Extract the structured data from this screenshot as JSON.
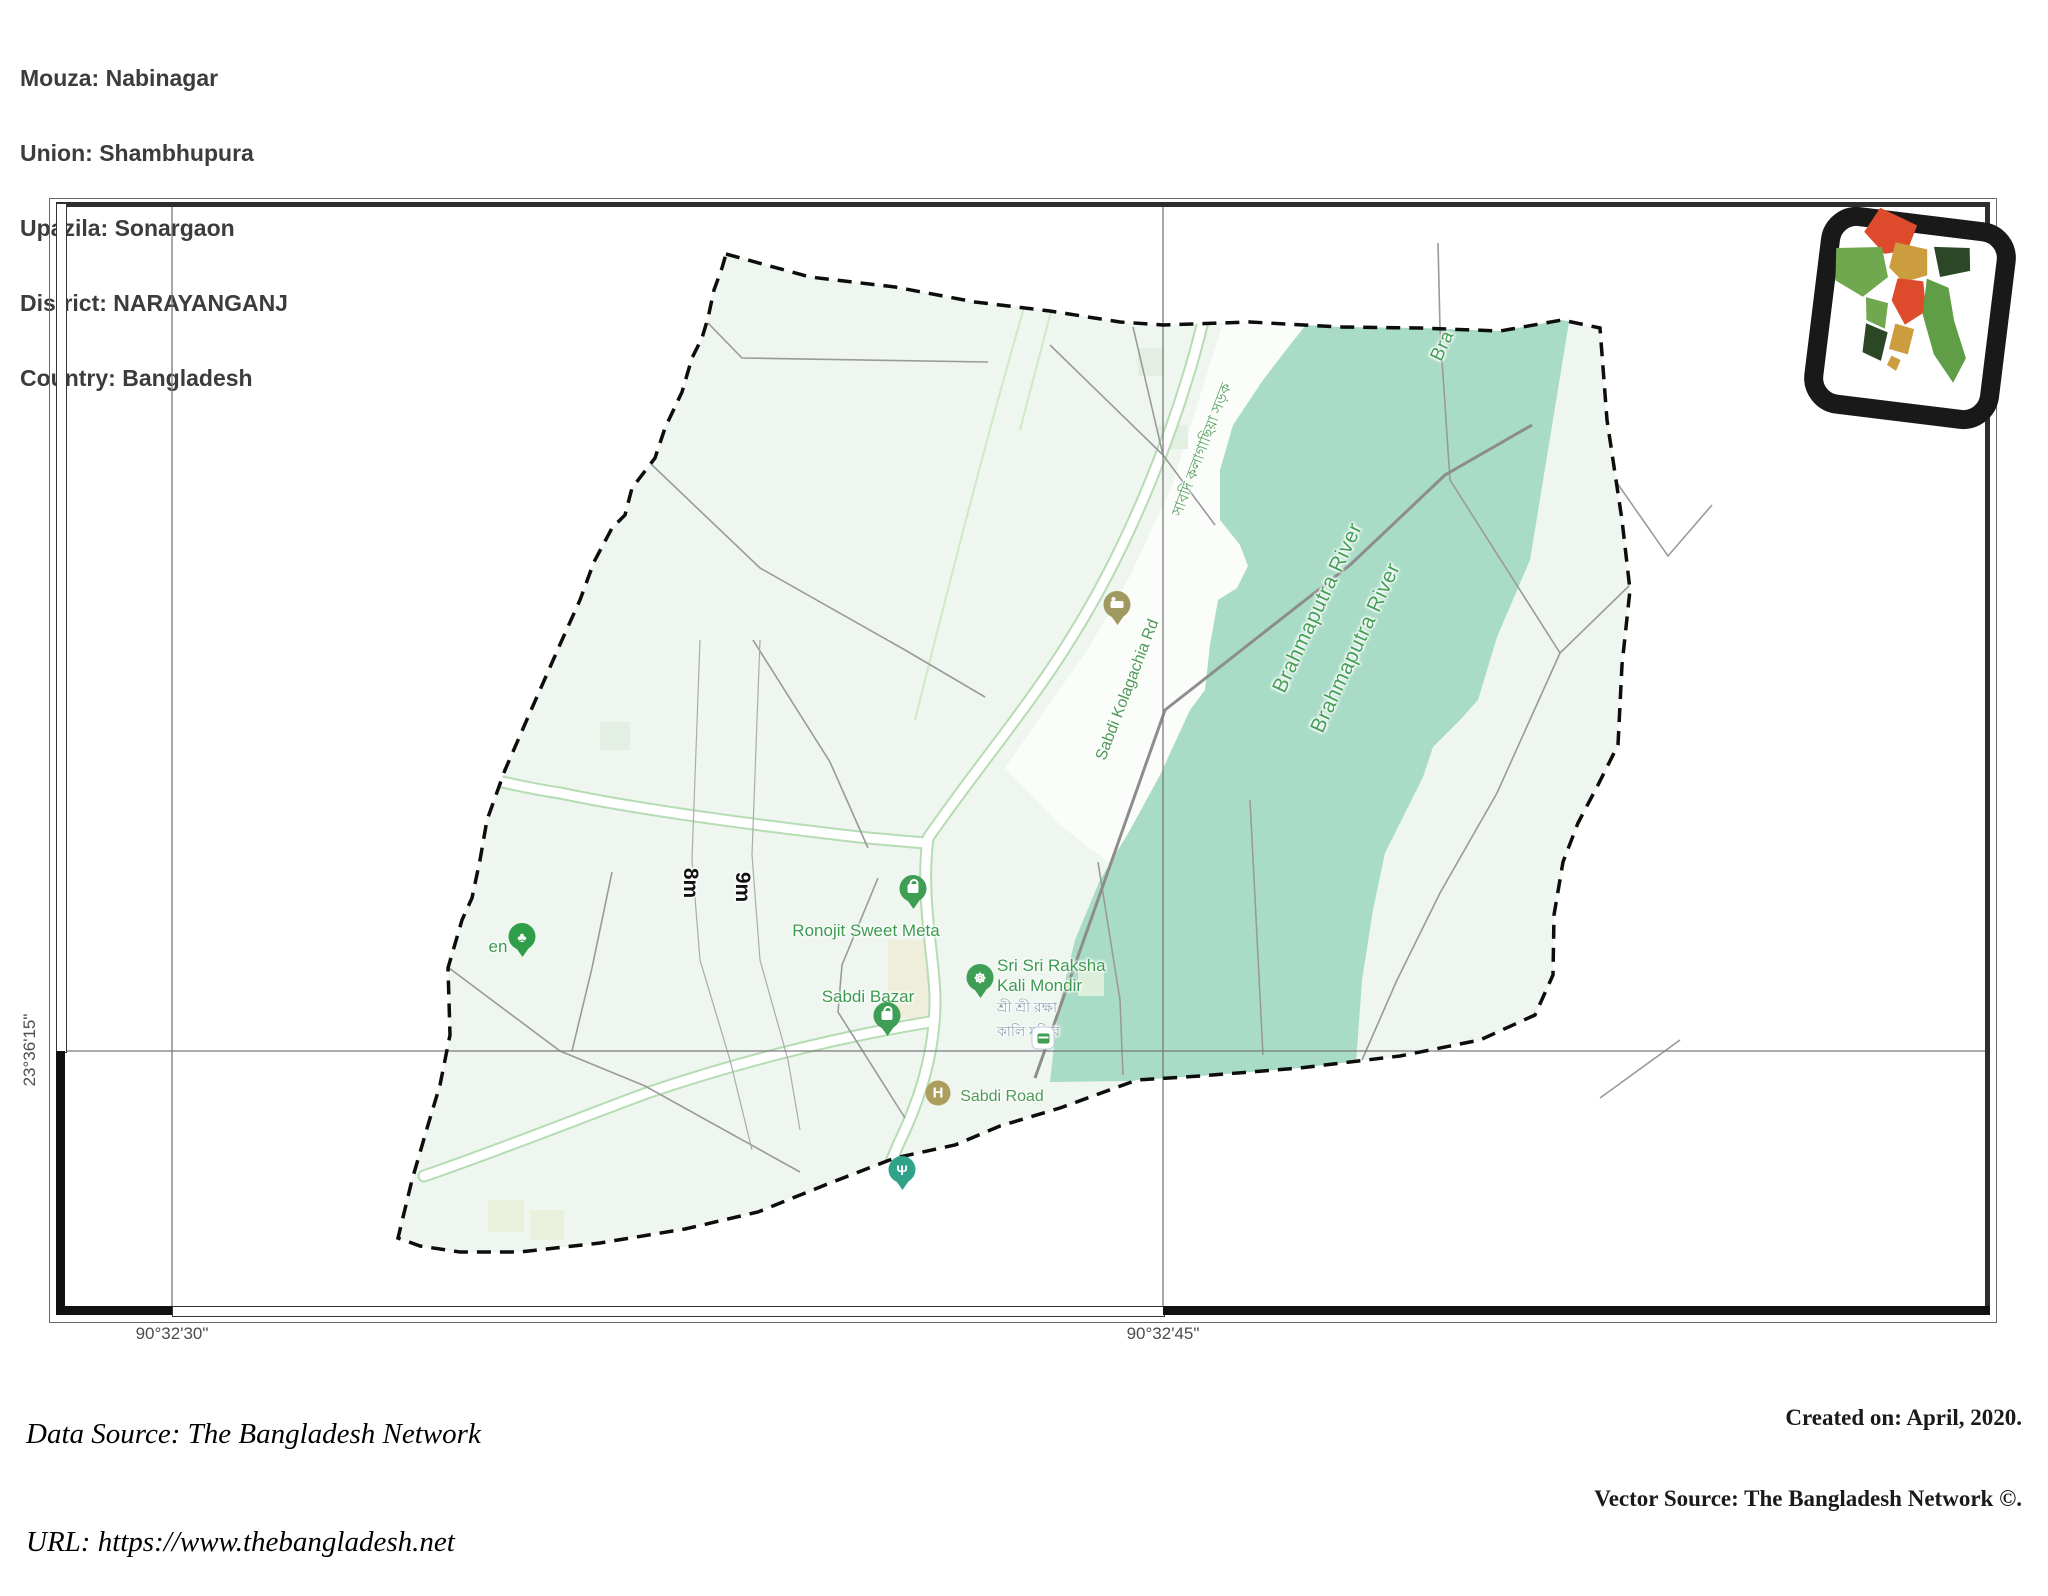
{
  "colors": {
    "land_tint": "#eef6ef",
    "river_teal": "#a9dcc7",
    "road_fill": "#ffffff",
    "road_casing": "#b5dcb2",
    "parcel_gray": "#9a9a9a",
    "boundary_black": "#0d0d0d",
    "poi_green": "#3d9b50",
    "pin_green": "#3e9e53",
    "pin_khaki": "#ac9f5e",
    "frame_dark": "#2e2e2e"
  },
  "header": {
    "line1": "Mouza: Nabinagar",
    "line2": "Union: Shambhupura",
    "line3": "Upazila: Sonargaon",
    "line4": "District: NARAYANGANJ",
    "line5": "Country: Bangladesh"
  },
  "map": {
    "axis": {
      "lon_left": "90°32'30\"",
      "lon_right": "90°32'45\"",
      "lat_left": "23°36'15\""
    },
    "contours": {
      "c8": "8m",
      "c9": "9m"
    },
    "roads": {
      "kolagachia_en": "Sabdi Kolagachia Rd",
      "kolagachia_bn": "সাবদি কলাগাছিয়া সড়ক",
      "sabdi_road": "Sabdi Road"
    },
    "river": {
      "label1": "Brahmaputra River",
      "label2": "Brahmaputra River",
      "partial": "Bra"
    },
    "pois": {
      "ronojit": "Ronojit Sweet Meta",
      "sabdi_bazar": "Sabdi Bazar",
      "mondir_en1": "Sri Sri Raksha",
      "mondir_en2": "Kali Mondir",
      "mondir_bn1": "শ্রী শ্রী রক্ষা",
      "mondir_bn2": "কালি মন্দির",
      "park_partial": "en",
      "hotel_glyph": "H",
      "mondir_glyph": "☸",
      "tree_glyph": "♣",
      "restaurant_glyph": "Ψ"
    }
  },
  "footer": {
    "data_source": "Data Source: The Bangladesh Network",
    "url": "URL: https://www.thebangladesh.net",
    "created": "Created on: April, 2020.",
    "vector_source": "Vector Source: The Bangladesh Network ©."
  }
}
